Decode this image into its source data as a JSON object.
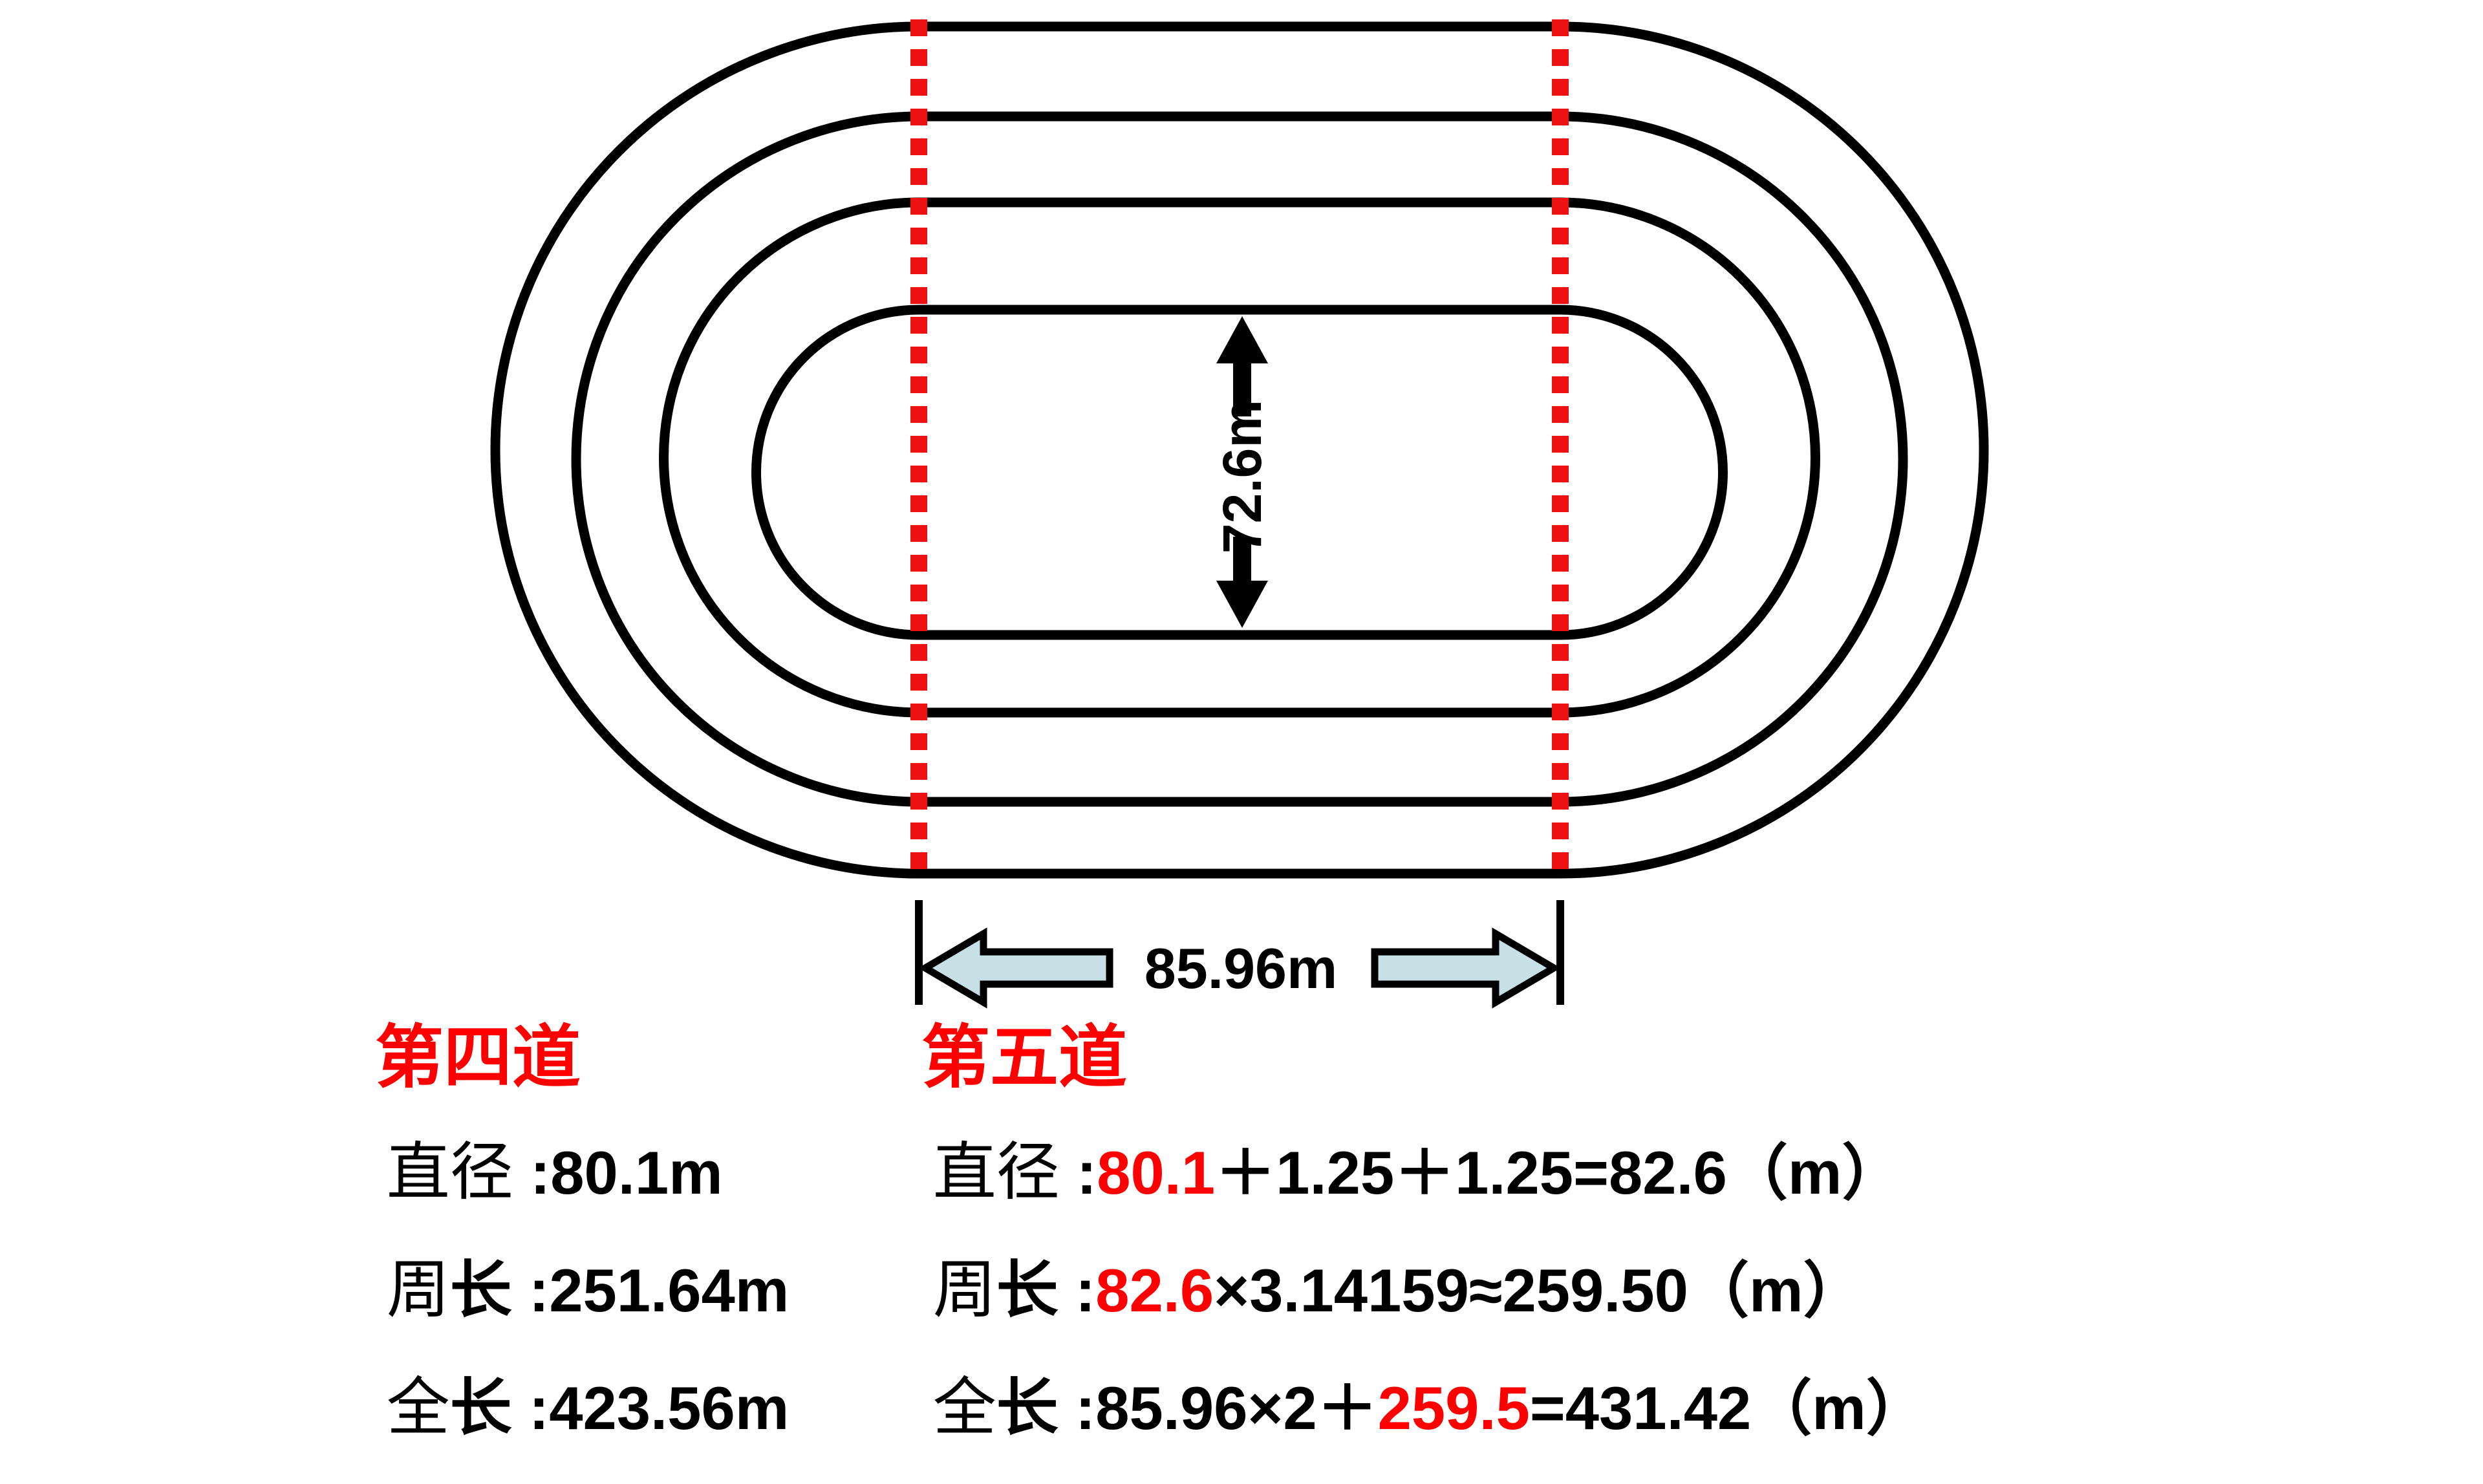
{
  "colors": {
    "track_line": "#000000",
    "dashed_marker": "#ed1111",
    "highlight_red": "#ff0000",
    "block_arrow_fill": "#c6e0e6"
  },
  "diagram": {
    "inner_width_label": "72.6m",
    "straight_length_label": "85.96m"
  },
  "lane4": {
    "title": "第四道",
    "rows": [
      {
        "label1": "直径",
        "label2": "",
        "colon": " :",
        "value": "80.1m"
      },
      {
        "label1": "周",
        "label2": "长",
        "colon": " :",
        "value": "251.64m"
      },
      {
        "label1": "全",
        "label2": "长",
        "colon": " :",
        "value": "423.56m"
      }
    ]
  },
  "lane5": {
    "title": "第五道",
    "rows": [
      {
        "label1": "直径",
        "label2": "",
        "colon": " :",
        "before": "",
        "red": "80.1",
        "after": "＋1.25＋1.25=82.6（m）"
      },
      {
        "label1": "周",
        "label2": "长",
        "colon": " :",
        "before": "",
        "red": "82.6",
        "after": "×3.14159≈259.50（m）"
      },
      {
        "label1": "全",
        "label2": "长",
        "colon": " :",
        "before": "85.96×2＋",
        "red": "259.5",
        "after": "=431.42（m）"
      }
    ]
  }
}
